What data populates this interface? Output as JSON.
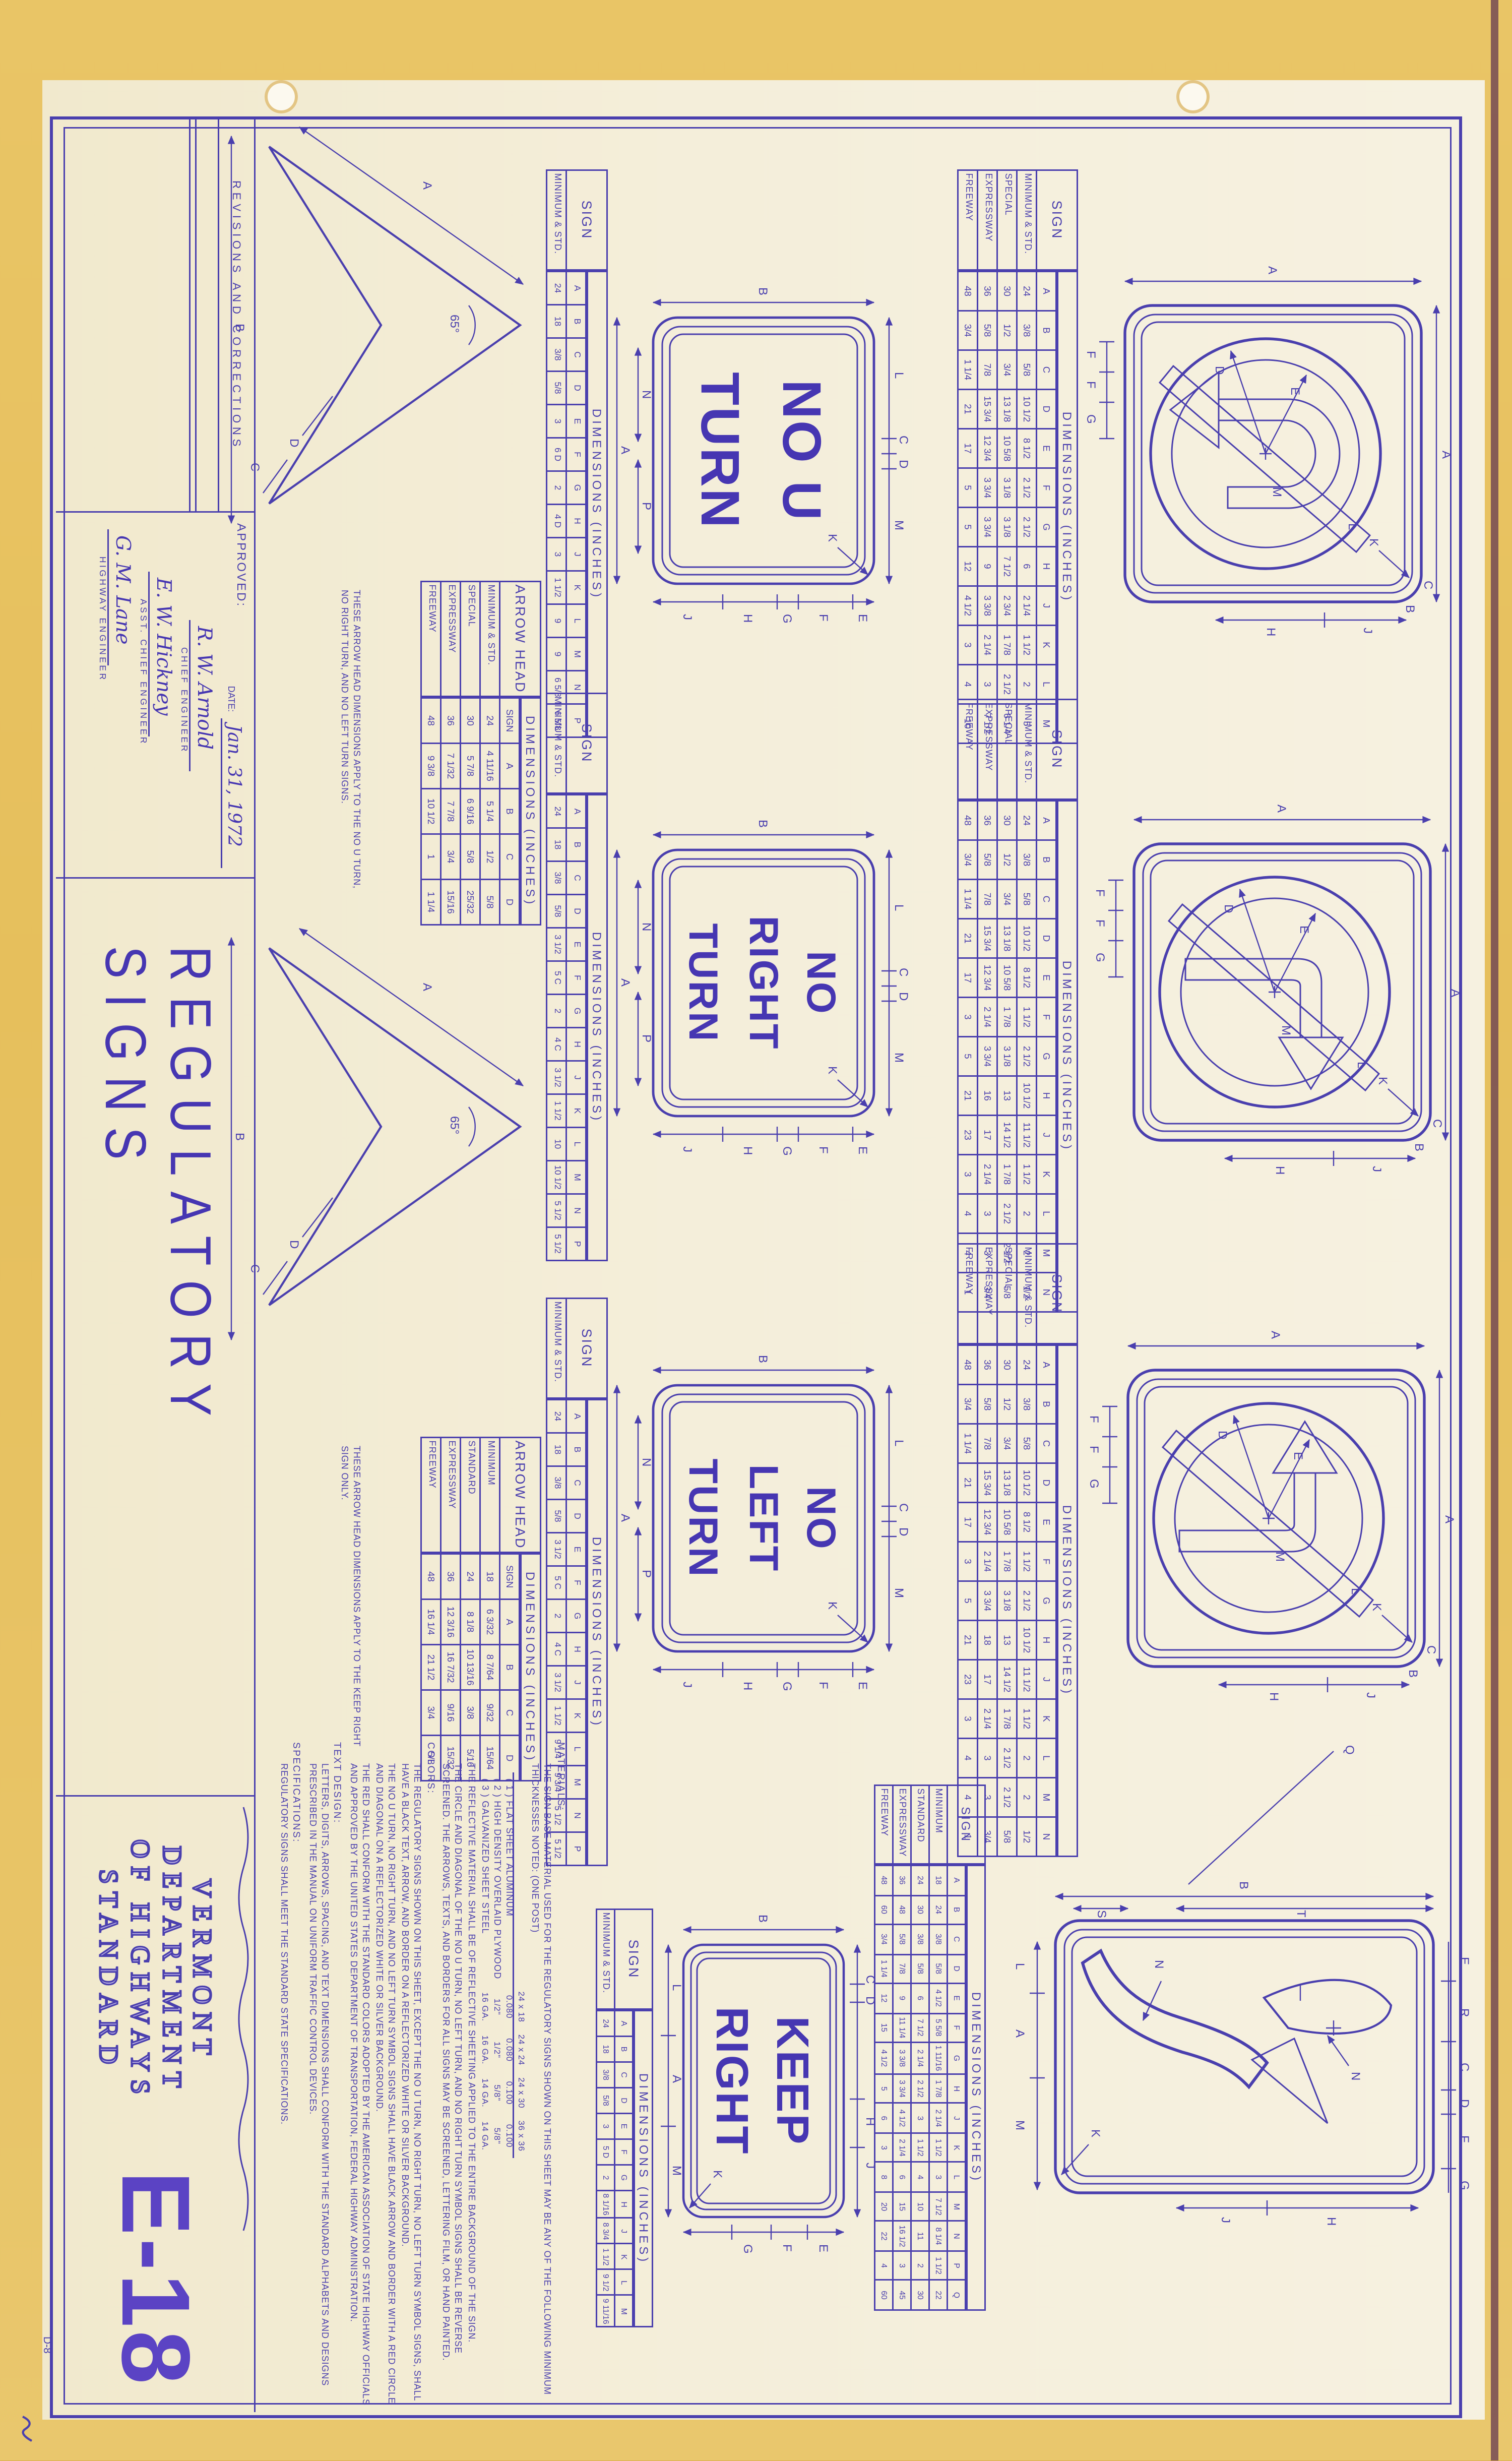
{
  "sheet": {
    "revisions_header": "REVISIONS AND CORRECTIONS",
    "approved_label": "APPROVED:",
    "date_label": "DATE:",
    "date_value": "Jan. 31, 1972",
    "signatures": [
      {
        "name": "R. W. Arnold",
        "title": "CHIEF ENGINEER"
      },
      {
        "name": "E. W. Hickney",
        "title": "ASST. CHIEF ENGINEER"
      },
      {
        "name": "G. M. Lane",
        "title": "HIGHWAY ENGINEER"
      }
    ],
    "sheet_title": "REGULATORY SIGNS",
    "agency_lines": [
      "VERMONT",
      "DEPARTMENT",
      "OF HIGHWAYS",
      "STANDARD"
    ],
    "sheet_number": "E-18",
    "corner_note": "D-8"
  },
  "signs": {
    "no_u_turn": {
      "lines": [
        "NO U",
        "TURN"
      ]
    },
    "no_right_turn": {
      "lines": [
        "NO",
        "RIGHT",
        "TURN"
      ]
    },
    "no_left_turn": {
      "lines": [
        "NO",
        "LEFT",
        "TURN"
      ]
    },
    "keep_right": {
      "lines": [
        "KEEP",
        "RIGHT"
      ]
    }
  },
  "dims": {
    "word_sign": {
      "a": "A",
      "b": "B",
      "top": [
        "L",
        "C",
        "D",
        "M"
      ],
      "bottom_inner": [
        "N",
        "P"
      ],
      "right": [
        "E",
        "F",
        "G",
        "H",
        "J"
      ],
      "k": "K"
    },
    "keep_right_sign": {
      "a": "A",
      "b": "B",
      "top": [
        "C",
        "D",
        "H",
        "J"
      ],
      "bottom": [
        "L",
        "A",
        "M"
      ],
      "right": [
        "E",
        "F",
        "G"
      ],
      "k": "K"
    },
    "symbol_sign": {
      "a_top": "A",
      "a_left": "A",
      "e": "E",
      "d": "D",
      "l": "L",
      "m": "M",
      "bottom": [
        "F",
        "F",
        "G"
      ],
      "right": [
        "J",
        "H"
      ],
      "c": "C",
      "b": "B",
      "k": "K"
    },
    "keep_right_symbol": {
      "b": "B",
      "t": "T",
      "s": "S",
      "top": [
        "E",
        "R",
        "C",
        "D",
        "F",
        "G"
      ],
      "bottom": [
        "L",
        "A",
        "M"
      ],
      "right": [
        "H",
        "J"
      ],
      "n": "N",
      "k": "K",
      "q": "Q"
    },
    "arrow_head": {
      "a": "A",
      "b": "B",
      "c": "C",
      "d": "D",
      "angle": "65°"
    }
  },
  "tables": {
    "symbol1": {
      "title": "SIGN",
      "dims": "DIMENSIONS (INCHES)",
      "cols": [
        "A",
        "B",
        "C",
        "D",
        "E",
        "F",
        "G",
        "H",
        "J",
        "K",
        "L",
        "M"
      ],
      "rows": [
        {
          "label": "MINIMUM & STD.",
          "values": [
            "24",
            "3/8",
            "5/8",
            "10 1/2",
            "8 1/2",
            "2 1/2",
            "2 1/2",
            "6",
            "2 1/4",
            "1 1/2",
            "2",
            "5"
          ]
        },
        {
          "label": "SPECIAL",
          "values": [
            "30",
            "1/2",
            "3/4",
            "13 1/8",
            "10 5/8",
            "3 1/8",
            "3 1/8",
            "7 1/2",
            "2 3/4",
            "1 7/8",
            "2 1/2",
            "6 1/4"
          ]
        },
        {
          "label": "EXPRESSWAY",
          "values": [
            "36",
            "5/8",
            "7/8",
            "15 3/4",
            "12 3/4",
            "3 3/4",
            "3 3/4",
            "9",
            "3 3/8",
            "2 1/4",
            "3",
            "7 1/2"
          ]
        },
        {
          "label": "FREEWAY",
          "values": [
            "48",
            "3/4",
            "1 1/4",
            "21",
            "17",
            "5",
            "5",
            "12",
            "4 1/2",
            "3",
            "4",
            "10"
          ]
        }
      ]
    },
    "word1": {
      "title": "SIGN",
      "dims": "DIMENSIONS (INCHES)",
      "cols": [
        "A",
        "B",
        "C",
        "D",
        "E",
        "F",
        "G",
        "H",
        "J",
        "K",
        "L",
        "M",
        "N",
        "P"
      ],
      "rows": [
        {
          "label": "MINIMUM & STD.",
          "values": [
            "24",
            "18",
            "3/8",
            "5/8",
            "3",
            "6 D",
            "2",
            "4 D",
            "3",
            "1 1/2",
            "9",
            "9",
            "6 5/8",
            "6 5/8"
          ]
        }
      ]
    },
    "ah1": {
      "title": "ARROW HEAD",
      "dims": "DIMENSIONS (INCHES)",
      "cols": [
        "SIGN",
        "A",
        "B",
        "C",
        "D"
      ],
      "rows": [
        {
          "label": "MINIMUM & STD.",
          "values": [
            "24",
            "4 11/16",
            "5 1/4",
            "1/2",
            "5/8"
          ]
        },
        {
          "label": "SPECIAL",
          "values": [
            "30",
            "5 7/8",
            "6 9/16",
            "5/8",
            "25/32"
          ]
        },
        {
          "label": "EXPRESSWAY",
          "values": [
            "36",
            "7 1/32",
            "7 7/8",
            "3/4",
            "15/16"
          ]
        },
        {
          "label": "FREEWAY",
          "values": [
            "48",
            "9 3/8",
            "10 1/2",
            "1",
            "1 1/4"
          ]
        }
      ]
    },
    "symbol2": {
      "title": "SIGN",
      "dims": "DIMENSIONS (INCHES)",
      "cols": [
        "A",
        "B",
        "C",
        "D",
        "E",
        "F",
        "G",
        "H",
        "J",
        "K",
        "L",
        "M",
        "N"
      ],
      "rows": [
        {
          "label": "MINIMUM & STD.",
          "values": [
            "24",
            "3/8",
            "5/8",
            "10 1/2",
            "8 1/2",
            "1 1/2",
            "2 1/2",
            "10 1/2",
            "11 1/2",
            "1 1/2",
            "2",
            "2",
            "1/2"
          ]
        },
        {
          "label": "SPECIAL",
          "values": [
            "30",
            "1/2",
            "3/4",
            "13 1/8",
            "10 5/8",
            "1 7/8",
            "3 1/8",
            "13",
            "14 1/2",
            "1 7/8",
            "2 1/2",
            "2 1/2",
            "5/8"
          ]
        },
        {
          "label": "EXPRESSWAY",
          "values": [
            "36",
            "5/8",
            "7/8",
            "15 3/4",
            "12 3/4",
            "2 1/4",
            "3 3/4",
            "16",
            "17",
            "2 1/4",
            "3",
            "3",
            "3/4"
          ]
        },
        {
          "label": "FREEWAY",
          "values": [
            "48",
            "3/4",
            "1 1/4",
            "21",
            "17",
            "3",
            "5",
            "21",
            "23",
            "3",
            "4",
            "4",
            "1"
          ]
        }
      ]
    },
    "word2": {
      "title": "SIGN",
      "dims": "DIMENSIONS (INCHES)",
      "cols": [
        "A",
        "B",
        "C",
        "D",
        "E",
        "F",
        "G",
        "H",
        "J",
        "K",
        "L",
        "M",
        "N",
        "P"
      ],
      "rows": [
        {
          "label": "MINIMUM & STD.",
          "values": [
            "24",
            "18",
            "3/8",
            "5/8",
            "3 1/2",
            "5 C",
            "2",
            "4 C",
            "3 1/2",
            "1 1/2",
            "10",
            "10 1/2",
            "5 1/2",
            "5 1/2"
          ]
        }
      ]
    },
    "symbol3": {
      "title": "SIGN",
      "dims": "DIMENSIONS (INCHES)",
      "cols": [
        "A",
        "B",
        "C",
        "D",
        "E",
        "F",
        "G",
        "H",
        "J",
        "K",
        "L",
        "M",
        "N"
      ],
      "rows": [
        {
          "label": "MINIMUM & STD.",
          "values": [
            "24",
            "3/8",
            "5/8",
            "10 1/2",
            "8 1/2",
            "1 1/2",
            "2 1/2",
            "10 1/2",
            "11 1/2",
            "1 1/2",
            "2",
            "2",
            "1/2"
          ]
        },
        {
          "label": "SPECIAL",
          "values": [
            "30",
            "1/2",
            "3/4",
            "13 1/8",
            "10 5/8",
            "1 7/8",
            "3 1/8",
            "13",
            "14 1/2",
            "1 7/8",
            "2 1/2",
            "2 1/2",
            "5/8"
          ]
        },
        {
          "label": "EXPRESSWAY",
          "values": [
            "36",
            "5/8",
            "7/8",
            "15 3/4",
            "12 3/4",
            "2 1/4",
            "3 3/4",
            "18",
            "17",
            "2 1/4",
            "3",
            "3",
            "3/4"
          ]
        },
        {
          "label": "FREEWAY",
          "values": [
            "48",
            "3/4",
            "1 1/4",
            "21",
            "17",
            "3",
            "5",
            "21",
            "23",
            "3",
            "4",
            "4",
            "1"
          ]
        }
      ]
    },
    "word3": {
      "title": "SIGN",
      "dims": "DIMENSIONS (INCHES)",
      "cols": [
        "A",
        "B",
        "C",
        "D",
        "E",
        "F",
        "G",
        "H",
        "J",
        "K",
        "L",
        "M",
        "N",
        "P"
      ],
      "rows": [
        {
          "label": "MINIMUM & STD.",
          "values": [
            "24",
            "18",
            "3/8",
            "5/8",
            "3 1/2",
            "5 C",
            "2",
            "4 C",
            "3 1/2",
            "1 1/2",
            "9 1/4",
            "9 3/4",
            "5 1/2",
            "5 1/2"
          ]
        }
      ]
    },
    "ah2": {
      "title": "ARROW HEAD",
      "dims": "DIMENSIONS (INCHES)",
      "cols": [
        "SIGN",
        "A",
        "B",
        "C",
        "D"
      ],
      "rows": [
        {
          "label": "MINIMUM",
          "values": [
            "18",
            "6 3/32",
            "8 7/64",
            "9/32",
            "15/64"
          ]
        },
        {
          "label": "STANDARD",
          "values": [
            "24",
            "8 1/8",
            "10 13/16",
            "3/8",
            "5/16"
          ]
        },
        {
          "label": "EXPRESSWAY",
          "values": [
            "36",
            "12 3/16",
            "16 7/32",
            "9/16",
            "15/32"
          ]
        },
        {
          "label": "FREEWAY",
          "values": [
            "48",
            "16 1/4",
            "21 1/2",
            "3/4",
            "5/8"
          ]
        }
      ]
    },
    "kr_symbol": {
      "title": "SIGN",
      "dims": "DIMENSIONS (INCHES)",
      "cols": [
        "A",
        "B",
        "C",
        "D",
        "E",
        "F",
        "G",
        "H",
        "J",
        "K",
        "L",
        "M",
        "N",
        "P",
        "Q"
      ],
      "rows": [
        {
          "label": "MINIMUM",
          "values": [
            "18",
            "24",
            "3/8",
            "5/8",
            "4 1/2",
            "5 5/8",
            "1 11/16",
            "1 7/8",
            "2 1/4",
            "1 1/2",
            "3",
            "7 1/2",
            "8 1/4",
            "1 1/2",
            "22"
          ]
        },
        {
          "label": "STANDARD",
          "values": [
            "24",
            "30",
            "3/8",
            "5/8",
            "6",
            "7 1/2",
            "2 1/4",
            "2 1/2",
            "3",
            "1 1/2",
            "4",
            "10",
            "11",
            "2",
            "30"
          ]
        },
        {
          "label": "EXPRESSWAY",
          "values": [
            "36",
            "48",
            "5/8",
            "7/8",
            "9",
            "11 1/4",
            "3 3/8",
            "3 3/4",
            "4 1/2",
            "2 1/4",
            "6",
            "15",
            "16 1/2",
            "3",
            "45"
          ]
        },
        {
          "label": "FREEWAY",
          "values": [
            "48",
            "60",
            "3/4",
            "1 1/4",
            "12",
            "15",
            "4 1/2",
            "5",
            "6",
            "3",
            "8",
            "20",
            "22",
            "4",
            "60"
          ]
        }
      ]
    },
    "kr_word": {
      "title": "SIGN",
      "dims": "DIMENSIONS (INCHES)",
      "cols": [
        "A",
        "B",
        "C",
        "D",
        "E",
        "F",
        "G",
        "H",
        "J",
        "K",
        "L",
        "M"
      ],
      "rows": [
        {
          "label": "MINIMUM & STD.",
          "values": [
            "24",
            "18",
            "3/8",
            "5/8",
            "3",
            "5 D",
            "2",
            "8 1/16",
            "8 3/4",
            "1 1/2",
            "9 1/2",
            "9 11/16"
          ]
        }
      ]
    },
    "thickness": {
      "simple": true,
      "cols": [
        "24 x 18",
        "24 x 24",
        "24 x 30",
        "36 x 36"
      ],
      "rows": [
        {
          "label": "( 1 ) FLAT SHEET ALUMINUM",
          "values": [
            "0.080",
            "0.080",
            "0.100",
            "0.100"
          ]
        },
        {
          "label": "( 2 ) HIGH DENSITY OVERLAID PLYWOOD",
          "values": [
            "1/2\"",
            "1/2\"",
            "5/8\"",
            "5/8\""
          ]
        },
        {
          "label": "( 3 ) GALVANIZED SHEET STEEL",
          "values": [
            "16 GA.",
            "16 GA.",
            "14 GA.",
            "14 GA."
          ]
        }
      ]
    }
  },
  "notes": {
    "arrow_note_1": "THESE ARROW HEAD DIMENSIONS APPLY TO THE NO U TURN, NO RIGHT TURN, AND NO LEFT TURN SIGNS.",
    "arrow_note_2": "THESE ARROW HEAD DIMENSIONS APPLY TO THE KEEP RIGHT SIGN ONLY.",
    "materials_label": "MATERIALS:",
    "materials_p1": "THE SIGN BASE MATERIAL USED FOR THE REGULATORY SIGNS SHOWN ON THIS SHEET MAY BE ANY OF THE FOLLOWING MINIMUM THICKNESSES NOTED: (ONE POST)",
    "materials_p2": "THE REFLECTIVE MATERIAL SHALL BE OF REFLECTIVE SHEETING APPLIED TO THE ENTIRE BACKGROUND OF THE SIGN.",
    "materials_p3": "THE CIRCLE AND DIAGONAL OF THE NO U TURN, NO LEFT TURN, AND NO RIGHT TURN SYMBOL SIGNS SHALL BE REVERSE SCREENED. THE ARROWS, TEXTS, AND BORDERS FOR ALL SIGNS MAY BE SCREENED, LETTERING FILM, OR HAND PAINTED.",
    "colors_label": "COLORS:",
    "colors_p1": "THE REGULATORY SIGNS SHOWN ON THIS SHEET, EXCEPT THE NO U TURN, NO RIGHT TURN, NO LEFT TURN SYMBOL SIGNS, SHALL HAVE A BLACK TEXT, ARROW, AND BORDER ON A REFLECTORIZED WHITE OR SILVER BACKGROUND.",
    "colors_p2": "THE NO U TURN, NO RIGHT TURN, AND NO LEFT TURN SYMBOL SIGNS SHALL HAVE BLACK ARROW AND BORDER WITH A RED CIRCLE AND DIAGONAL ON A REFLECTORIZED WHITE OR SILVER BACKGROUND.",
    "colors_p3": "THE RED SHALL CONFORM WITH THE STANDARD COLORS ADOPTED BY THE AMERICAN ASSOCIATION OF STATE HIGHWAY OFFICIALS AND APPROVED BY THE UNITED STATES DEPARTMENT OF TRANSPORTATION, FEDERAL HIGHWAY ADMINISTRATION.",
    "text_design_label": "TEXT DESIGN:",
    "text_design_p": "LETTERS, DIGITS, ARROWS, SPACING, AND TEXT DIMENSIONS SHALL CONFORM WITH THE STANDARD ALPHABETS AND DESIGNS PRESCRIBED IN THE MANUAL ON UNIFORM TRAFFIC CONTROL DEVICES.",
    "specifications_label": "SPECIFICATIONS:",
    "specifications_p": "REGULATORY SIGNS SHALL MEET THE STANDARD STATE SPECIFICATIONS."
  },
  "colors": {
    "ink": "#4a3fae",
    "sheet": "#f5f0dd",
    "backing_gold": "#e7c160",
    "edge": "#6d4152"
  }
}
